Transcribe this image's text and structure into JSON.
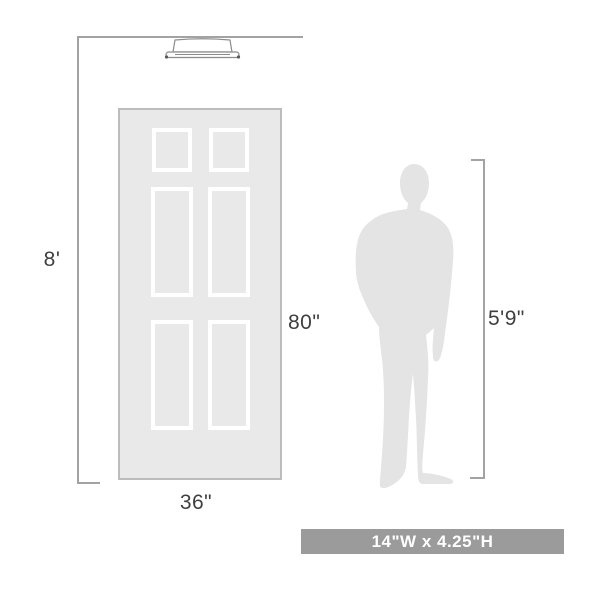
{
  "diagram": {
    "ceiling_height_label": "8'",
    "door_height_label": "80\"",
    "door_width_label": "36\"",
    "person_height_label": "5'9\"",
    "banner_text": "14\"W x 4.25\"H"
  },
  "icons": {
    "fixture": "flush-mount-ceiling-light",
    "door": "six-panel-door",
    "person": "man-silhouette"
  },
  "colors": {
    "background": "#ffffff",
    "dimension_line": "#a3a3a3",
    "label_text": "#3f3f3f",
    "door_fill": "#e9e9e9",
    "door_border": "#bcbcbc",
    "panel_frame": "#ffffff",
    "person_fill": "#e4e4e4",
    "fixture_outline": "#8c8c8c",
    "banner_background": "#9b9b9b",
    "banner_text_color": "#ffffff"
  }
}
